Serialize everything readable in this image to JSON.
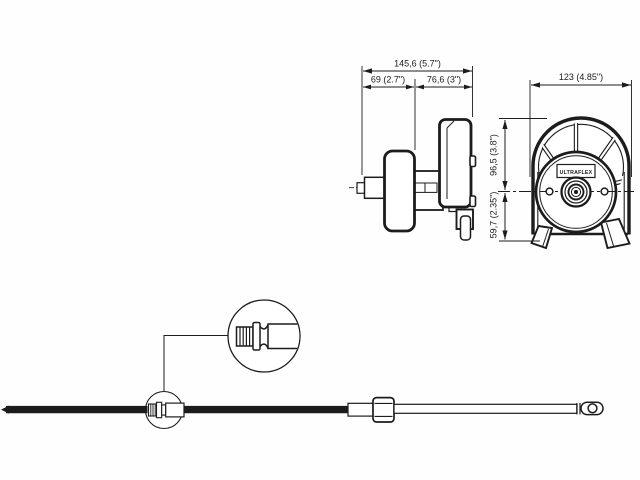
{
  "diagram": {
    "brand": "ULTRAFLEX",
    "side_view": {
      "dim_total": "145,6 (5.7\")",
      "dim_left": "69 (2.7\")",
      "dim_right": "76,6 (3\")"
    },
    "front_view": {
      "dim_width": "123 (4.85\")",
      "dim_upper": "96,5 (3.8\")",
      "dim_lower": "59,7 (2.35\")"
    }
  }
}
